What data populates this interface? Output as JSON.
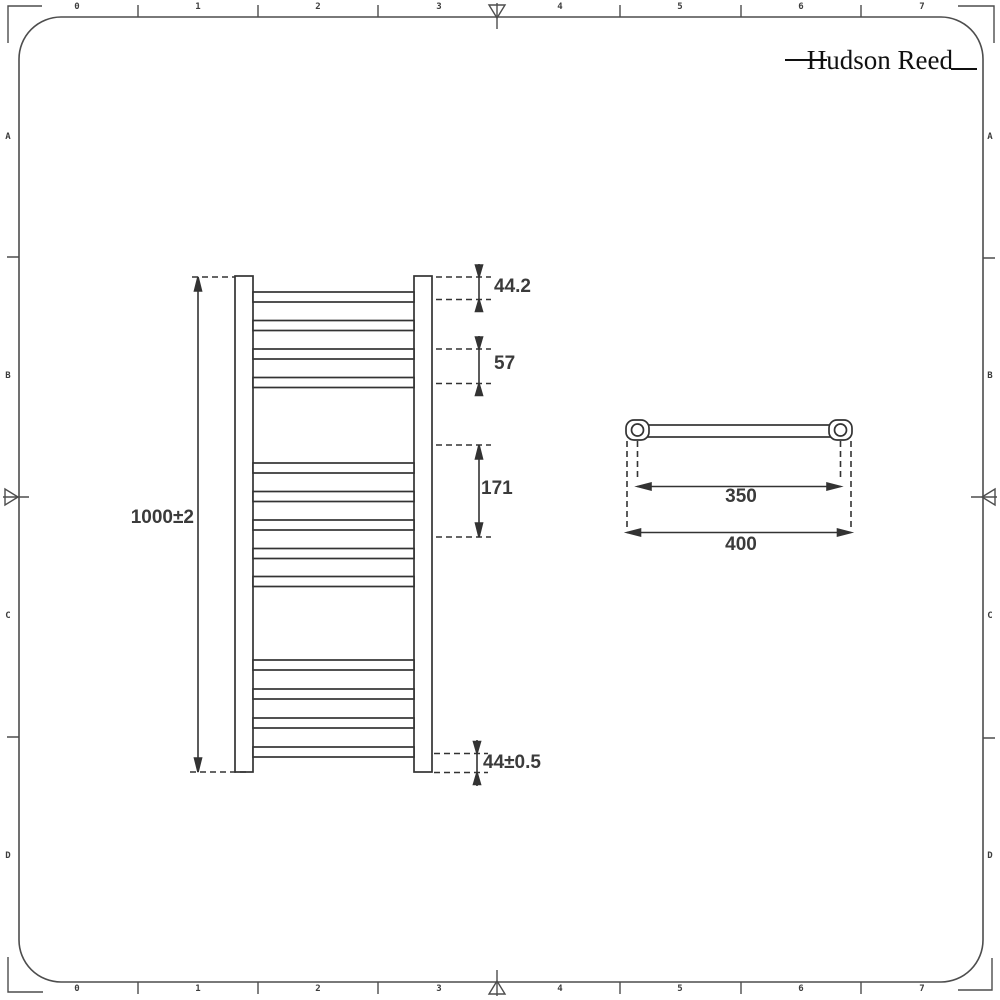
{
  "logo": {
    "text": "Hudson Reed"
  },
  "ruler": {
    "h_numbers": [
      "0",
      "1",
      "2",
      "3",
      "4",
      "5",
      "6",
      "7"
    ],
    "v_letters": [
      "A",
      "B",
      "C",
      "D"
    ]
  },
  "front_view": {
    "description": "front elevation of ladder towel radiator, 13 rungs in groups 4-5-4",
    "dims": {
      "height": "1000±2",
      "top_offset": "44.2",
      "rung_pitch": "57",
      "mid_section": "171",
      "bottom_offset": "44±0.5"
    }
  },
  "top_view": {
    "description": "plan view of rail with two wall brackets",
    "dims": {
      "bracket_centres": "350",
      "overall_width": "400"
    }
  },
  "colors": {
    "background": "#ffffff",
    "frame": "#4d4d4d",
    "line": "#333333",
    "dim_text": "#3b3b3b",
    "logo": "#101010"
  }
}
